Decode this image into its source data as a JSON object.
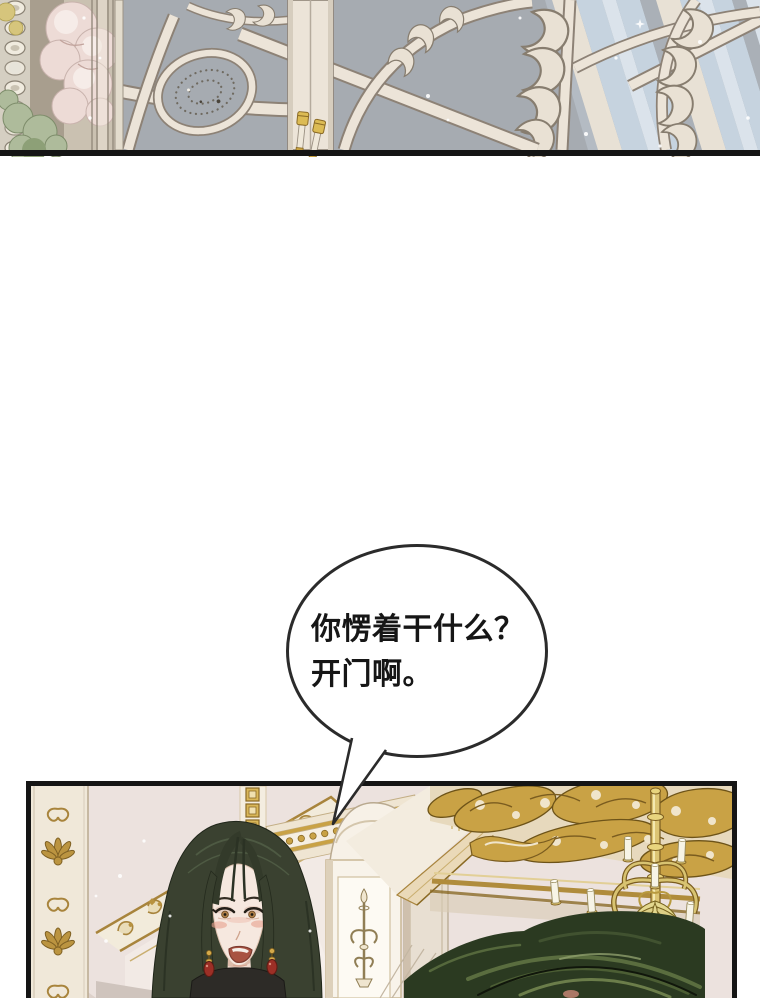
{
  "page": {
    "width_px": 760,
    "height_px": 998,
    "background": "#ffffff"
  },
  "speech_bubble": {
    "line1": "你愣着干什么？",
    "line2": "开门啊。",
    "outline": "#2b2b2b",
    "fill": "#ffffff",
    "text_color": "#161616"
  },
  "panels": {
    "ceiling": {
      "alt": "Ornate palace ceiling seen from below: ivory scrollwork ribs and a beaded oval medallion on a grey-blue vault, pale blue striped skylight at right, pink roses and green leaves on the left pillar, two gold-capped finials",
      "palette": {
        "vault_grey": "#a6abb1",
        "scroll_ivory": "#ece4d8",
        "scroll_outline": "#8d8276",
        "skylight_blue": "#c6d3df",
        "gold_finial": "#dcbb54",
        "rose_pink": "#eddbd6",
        "leaf_green": "#aebb9b",
        "border_black": "#151515"
      }
    },
    "hall": {
      "alt": "Gilded palace hall: a woman with long dark hair and red earrings looks annoyed while speaking; gold filigree arch and pilaster at left, white column with candelabrum motif, golden ceiling scrollwork and a candle chandelier at right, dark green swirling hair mass in the lower right",
      "palette": {
        "wall_pink": "#ece2de",
        "gold": "#c9a245",
        "gold_dark": "#6d5318",
        "hair_dark": "#3a4130",
        "skin": "#f6e8df",
        "blush": "#e8a08d",
        "earring_red": "#9c2f26",
        "candle_ivory": "#f7f4e6",
        "swirl_green": "#2b3a21",
        "border_black": "#151515"
      }
    }
  }
}
